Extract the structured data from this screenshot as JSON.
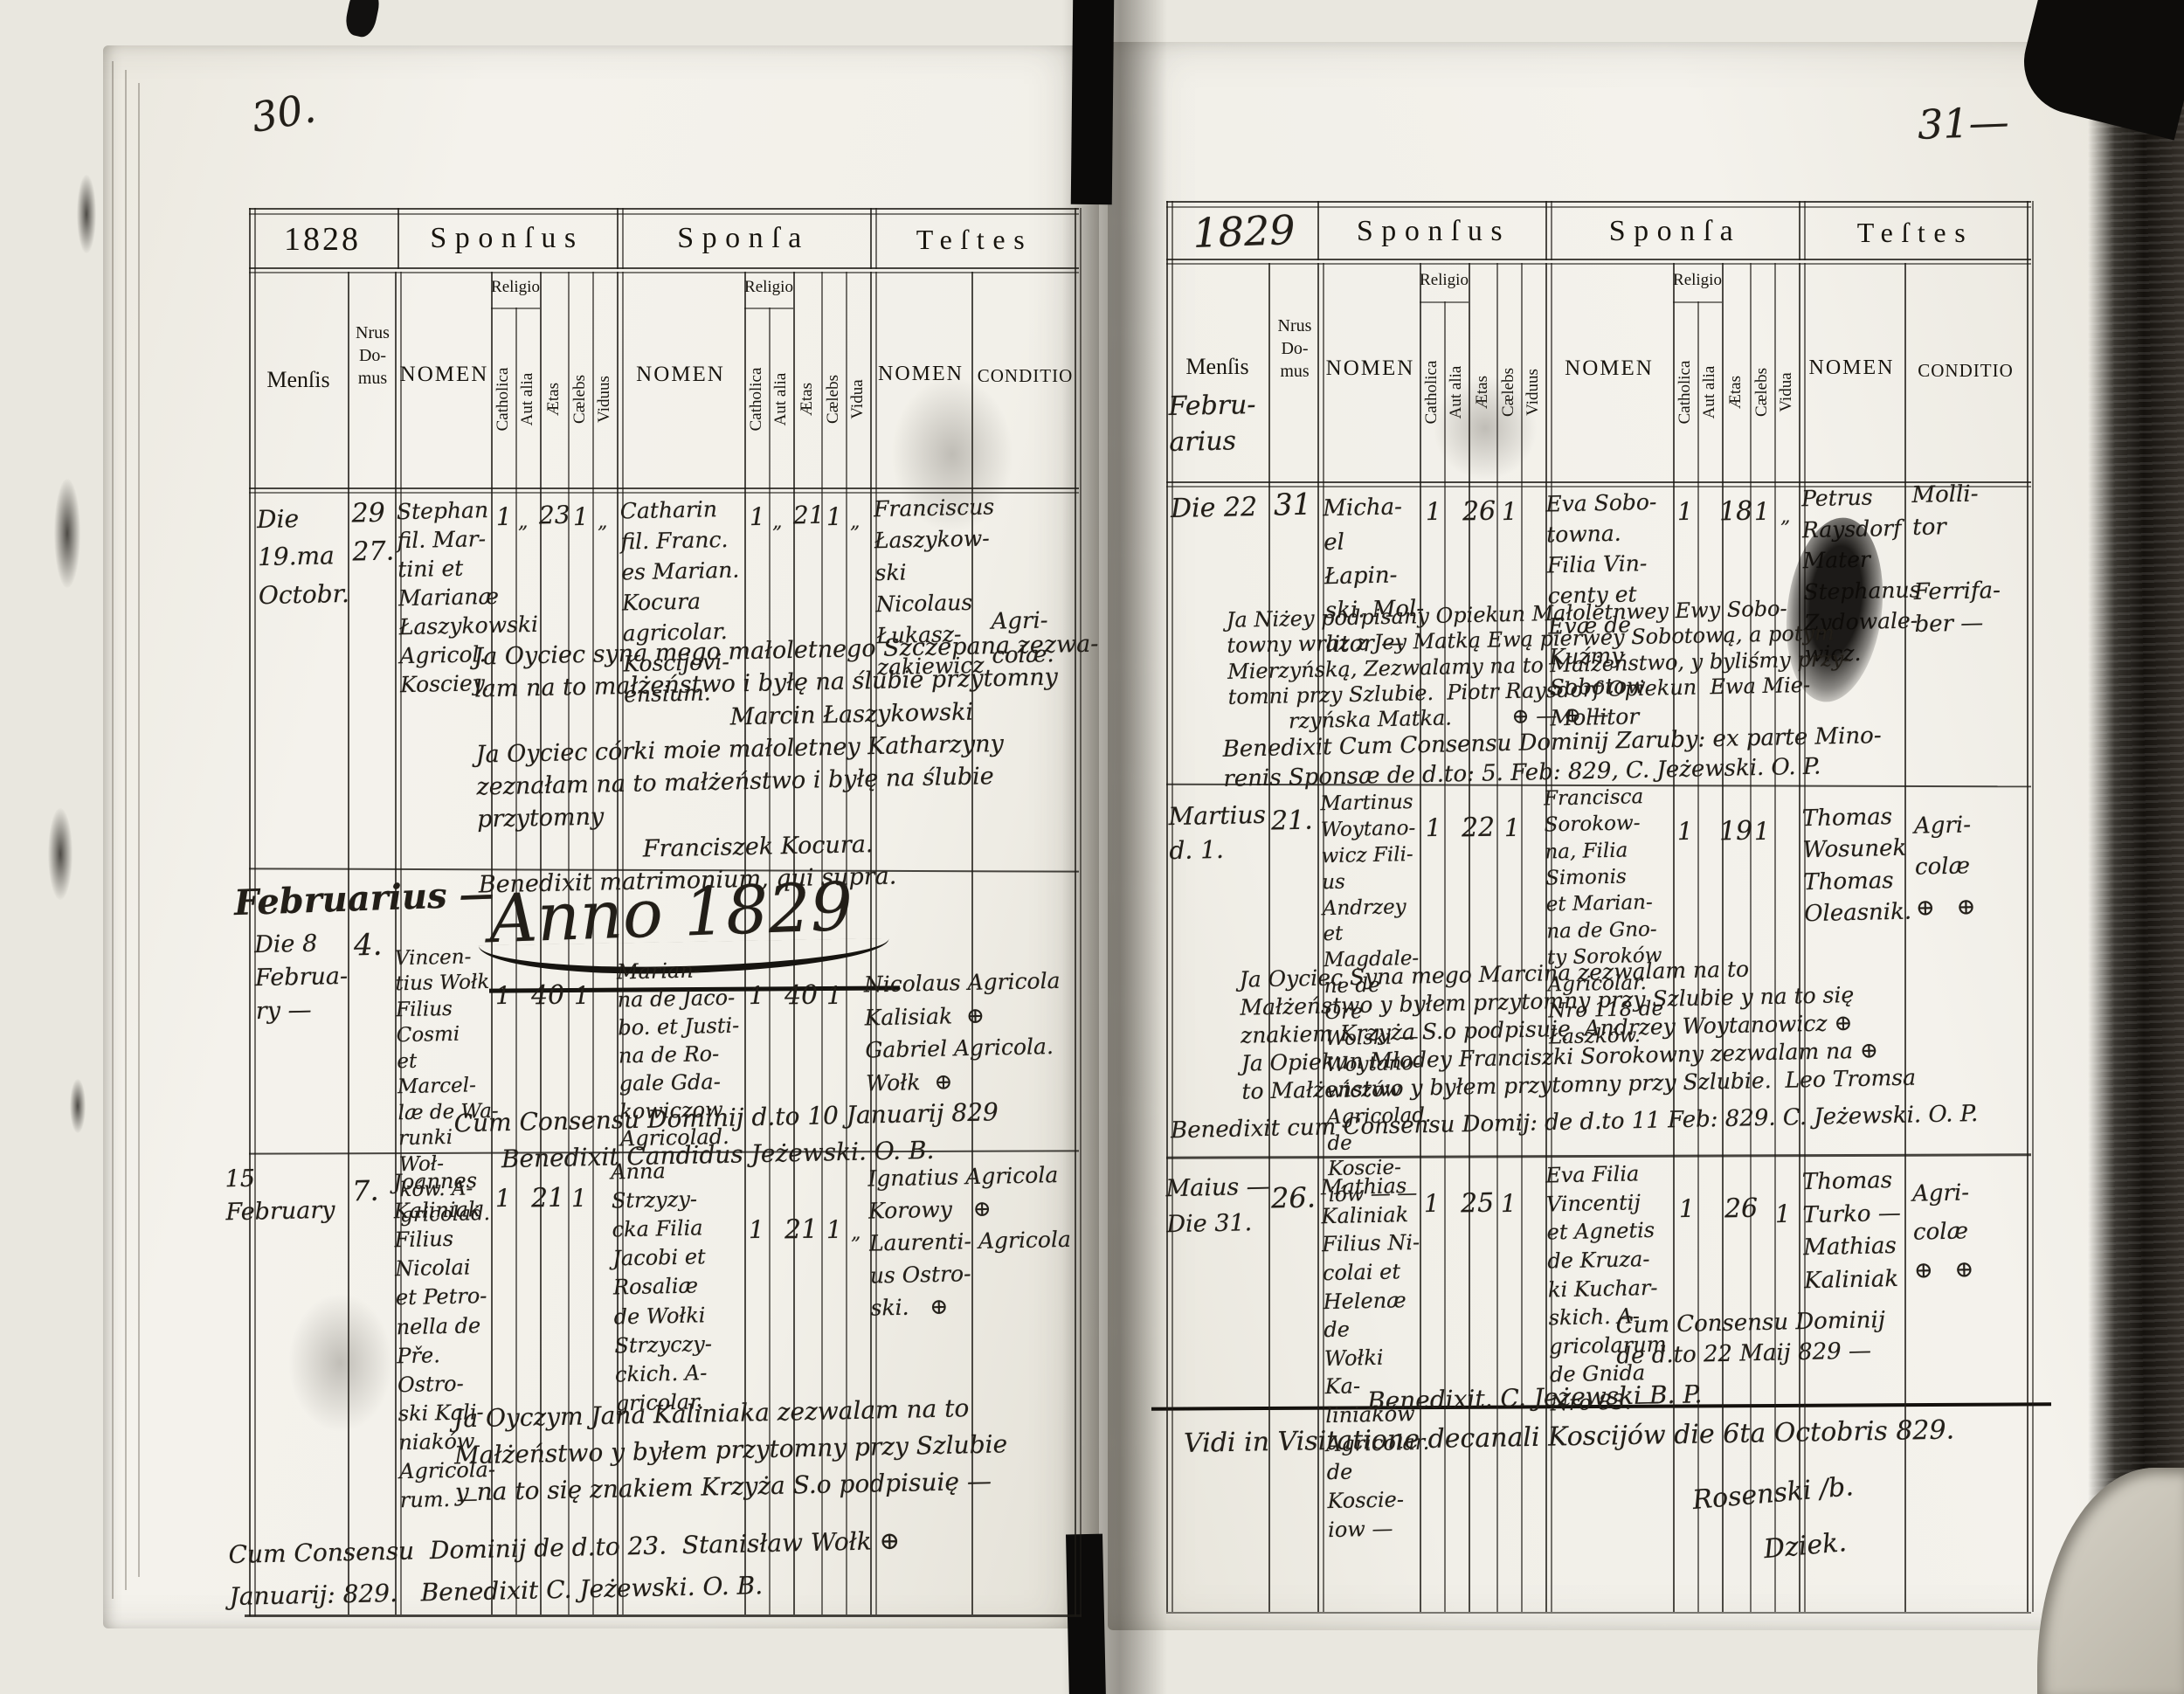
{
  "labels": {
    "sponsus": "Sponſus",
    "sponsa": "Sponſa",
    "testes": "Teſtes",
    "mensis": "Menſis",
    "nrus_domus": "Nrus\nDo-\nmus",
    "nomen": "NOMEN",
    "religio": "Religio",
    "catholica": "Catholica",
    "aut_alia": "Aut alia",
    "aetas": "Ætas",
    "caelebs": "Cælebs",
    "viduus": "Viduus",
    "vidua": "Vidua",
    "conditio": "CONDITIO"
  },
  "left": {
    "page_number": "30.",
    "year": "1828",
    "section_month": "Februarius —",
    "anno_heading": "Anno 1829",
    "entries": [
      {
        "mensis": "Die\n19.ma\nOctobr.",
        "nrus": "29\n27.",
        "sponsus_nomen": "Stephan\nfil. Mar-\ntini et\nMarianæ\nŁaszykowski\nAgricol.\nKosciey.",
        "sponsus_cath": "1",
        "sponsus_alia": "„",
        "sponsus_aetas": "23",
        "sponsus_caelebs": "1",
        "sponsus_viduus": "„",
        "sponsa_nomen": "Catharin\nfil. Franc.\nes Marian.\nKocura\nagricolar.\nKoscijovi-\nensium.",
        "sponsa_cath": "1",
        "sponsa_alia": "„",
        "sponsa_aetas": "21",
        "sponsa_caelebs": "1",
        "sponsa_vidua": "„",
        "testes_nomen": "Franciscus\nŁaszykow-\nski\nNicolaus\nŁukasz-\nzakiewicz",
        "conditio": "Agri-\ncolæ.",
        "note": "Ja Oyciec syna mego małoletnego Szczepana zezwa-\nlam na to małżeństwo i byłę na ślubie przytomny\n                                  Marcin Łaszykowski\nJa Oyciec córki moie małoletney Katharzyny\nzeznałam na to małżeństwo i byłę na ślubie przytomny\n                      Franciszek Kocura.\nBenedixit matrimonium, qui supra."
      },
      {
        "mensis": "Die 8\nFebrua-\nry —",
        "nrus": "4.",
        "sponsus_nomen": "Vincen-\ntius Wołk\nFilius Cosmi\net Marcel-\nlæ de Wa-\nrunki Woł-\nków. A-\ngricolad.",
        "sponsus_cath": "1",
        "sponsus_aetas": "40",
        "sponsus_caelebs": "1",
        "sponsa_nomen": "Marian-\nna de Jaco-\nbo. et Justi-\nna de Ro-\ngale Gda-\nkowiczow\nAgricolad.",
        "sponsa_cath": "1",
        "sponsa_aetas": "40",
        "sponsa_caelebs": "1",
        "testes_nomen": "Nicolaus Agricola\nKalisiak  ⊕\nGabriel Agricola.\nWołk  ⊕",
        "note": "Cum Consensu Dominij d.to 10 Januarij 829\n      Benedixit Candidus Jeżewski. O. B."
      },
      {
        "mensis": "15\nFebruary",
        "nrus": "7.",
        "sponsus_nomen": "Joannes\nKaliniak\nFilius\nNicolai\net Petro-\nnella de\nPře. Ostro-\nski Kali-\nniaków.\nAgricola-\nrum. —",
        "sponsus_cath": "1",
        "sponsus_aetas": "21",
        "sponsus_caelebs": "1",
        "sponsa_nomen": "Anna\nStrzyzy-\ncka Filia\nJacobi et\nRosaliæ\nde Wołki\nStrzyczy-\nckich. A-\ngricolar.",
        "sponsa_cath": "1",
        "sponsa_aetas": "21",
        "sponsa_caelebs": "1",
        "sponsa_vidua": "„",
        "testes_nomen": "Ignatius Agricola\nKorowy   ⊕\nLaurenti- Agricola\nus Ostro-\nski.   ⊕",
        "note": "Ja Oyczym Jana Kaliniaka zezwalam na to\nMałżeństwo y byłem przytomny przy Szlubie\ny na to się znakiem Krzyża S.o podpisuię —",
        "note2": "Cum Consensu  Dominij de d.to 23.  Stanisław Wołk ⊕\nJanuarij: 829.   Benedixit C. Jeżewski. O. B."
      }
    ]
  },
  "right": {
    "page_number": "31—",
    "year": "1829",
    "mensis_note": "Febru-\narius",
    "entries": [
      {
        "mensis": "Die 22",
        "nrus": "31",
        "sponsus_nomen": "Micha-\nel Łapin-\nski. Mol-\nlitor —",
        "sponsus_cath": "1",
        "sponsus_aetas": "26",
        "sponsus_caelebs": "1",
        "sponsa_nomen": "Eva Sobo-\ntowna.\nFilia Vin-\ncenty et\nEvæ de\nKuźmy\nSobotow\nMollitor",
        "sponsa_cath": "1",
        "sponsa_aetas": "18",
        "sponsa_caelebs": "1",
        "sponsa_vidua": "„",
        "testes_nomen": "Petrus\nRaysdorf\nMater\nStephanus\nZydowale-\nwicz.",
        "conditio": "Molli-\ntor\n\nFerrifa-\nber —",
        "note": "Ja Niżey podpisany Opiekun Małoletnwey Ewy Sobo-\ntowny wraz z Jey Matką Ewą pierwey Sobotową, a potym\nMierzyńską, Zezwalamy na to Małżeństwo, y byliśmy przy-\ntomni przy Szlubie.  Piotr Raysdorf Opiekun  Ewa Mie-\n         rzyńska Matka.         ⊕ — ⊕ —",
        "note2": "Benedixit Cum Consensu Dominij Zaruby: ex parte Mino-\nrenis Sponsæ de d.to: 5. Feb: 829, C. Jeżewski. O. P."
      },
      {
        "mensis": "Martius\nd. 1.",
        "nrus": "21.",
        "sponsus_nomen": "Martinus\nWoytano-\nwicz Fili-\nus Andrzey\net Magdale-\nne de Ore\nWolski —\nWoytano-\nwiczów\nAgricolad.\nde Koscie-\niów — —",
        "sponsus_cath": "1",
        "sponsus_aetas": "22",
        "sponsus_caelebs": "1",
        "sponsa_nomen": "Francisca\nSorokow-\nna, Filia\nSimonis\net Marian-\nna de Gno-\nty Soroków\nAgricolar.\nNro 118 de\nŁaszków.",
        "sponsa_cath": "1",
        "sponsa_aetas": "19",
        "sponsa_caelebs": "1",
        "testes_nomen": "Thomas\nWosunek\nThomas\nOleasnik.",
        "conditio": "Agri-\ncolæ\n⊕   ⊕",
        "note": "Ja Oyciec Syna mego Marcina zezwalam na to\nMałżeństwo y byłem przytomny przy Szlubie y na to się\nznakiem Krzyża S.o podpisuię  Andrzey Woytanowicz ⊕\nJa Opiekun Młodey Franciszki Sorokowny zezwalam na ⊕\nto Małżeństwo y byłem przytomny przy Szlubie.  Leo Tromsa",
        "note2": "Benedixit cum Consensu Domij: de d.to 11 Feb: 829. C. Jeżewski. O. P."
      },
      {
        "mensis": "Maius —\nDie 31.",
        "nrus": "26.",
        "sponsus_nomen": "Mathias\nKaliniak\nFilius Ni-\ncolai et\nHelenæ de\nWołki Ka-\nliniaków\nAgricolar.\nde Koscie-\niow —",
        "sponsus_cath": "1",
        "sponsus_aetas": "25",
        "sponsus_caelebs": "1",
        "sponsa_nomen": "Eva Filia\nVincentij\net Agnetis\nde Kruza-\nki Kuchar-\nskich. A-\ngricolarum\nde Gnida\nNro 83. —",
        "sponsa_cath": "1",
        "sponsa_aetas": "26",
        "sponsa_caelebs": "1",
        "testes_nomen": "Thomas\nTurko —\nMathias\nKaliniak",
        "conditio": "Agri-\ncolæ\n⊕   ⊕",
        "note": "Cum Consensu Dominij\nde d.to 22 Maij 829 —",
        "note2": "Benedixit. C. Jeżewski B. P."
      }
    ],
    "visitation": "Vidi in Visitatione decanali Koscijów die 6ta Octobris 829.",
    "visitation_signature": "Rosenski /b.\n        Dziek."
  }
}
